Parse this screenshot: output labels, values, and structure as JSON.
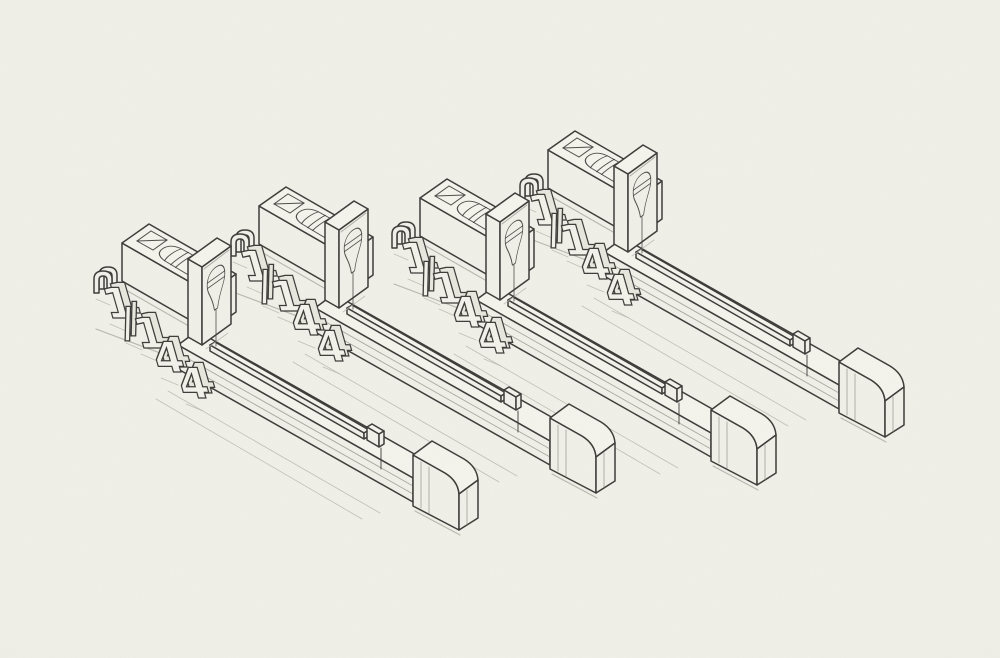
{
  "scene": {
    "subject": "Hand-drawn isometric line illustration of four identical 1/144 scale model sprue sets on paper",
    "background_color": "#ecebe3",
    "paper_color": "#f0efe8",
    "ink_color": "#3b3b38",
    "light_line_color": "#a9a8a0",
    "shadow_color": "#b8b7ae"
  },
  "marking": {
    "text": "1/144",
    "glyphs": [
      "1",
      "/",
      "1",
      "4",
      "4"
    ]
  },
  "clusters": [
    {
      "name": "part-set-4",
      "x": 548,
      "y": 150
    },
    {
      "name": "part-set-3",
      "x": 420,
      "y": 198
    },
    {
      "name": "part-set-2",
      "x": 259,
      "y": 206
    },
    {
      "name": "part-set-1",
      "x": 122,
      "y": 243
    }
  ]
}
